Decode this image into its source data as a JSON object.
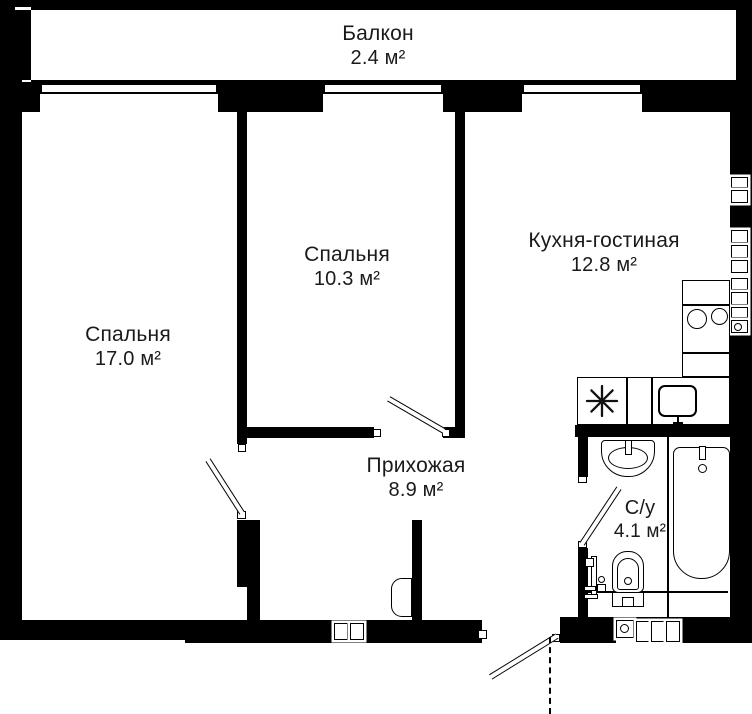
{
  "rooms": [
    {
      "id": "balcony",
      "name": "Балкон",
      "area": "2.4 м²"
    },
    {
      "id": "bedroom-1",
      "name": "Спальня",
      "area": "17.0 м²"
    },
    {
      "id": "bedroom-2",
      "name": "Спальня",
      "area": "10.3 м²"
    },
    {
      "id": "kitchen-living",
      "name": "Кухня-гостиная",
      "area": "12.8 м²"
    },
    {
      "id": "hallway",
      "name": "Прихожая",
      "area": "8.9 м²"
    },
    {
      "id": "bathroom",
      "name": "С/у",
      "area": "4.1 м²"
    }
  ],
  "fixtures": [
    "window",
    "interior-door",
    "entrance-door",
    "bathtub",
    "bathroom-sink",
    "toilet",
    "towel-dryer",
    "kitchen-sink",
    "stove-burners",
    "kitchen-counter",
    "sink-star",
    "vent-shaft-boxes",
    "closet-door"
  ],
  "colors": {
    "wall": "#000000",
    "floor": "#ffffff",
    "label_text": "#1a1a1a"
  }
}
